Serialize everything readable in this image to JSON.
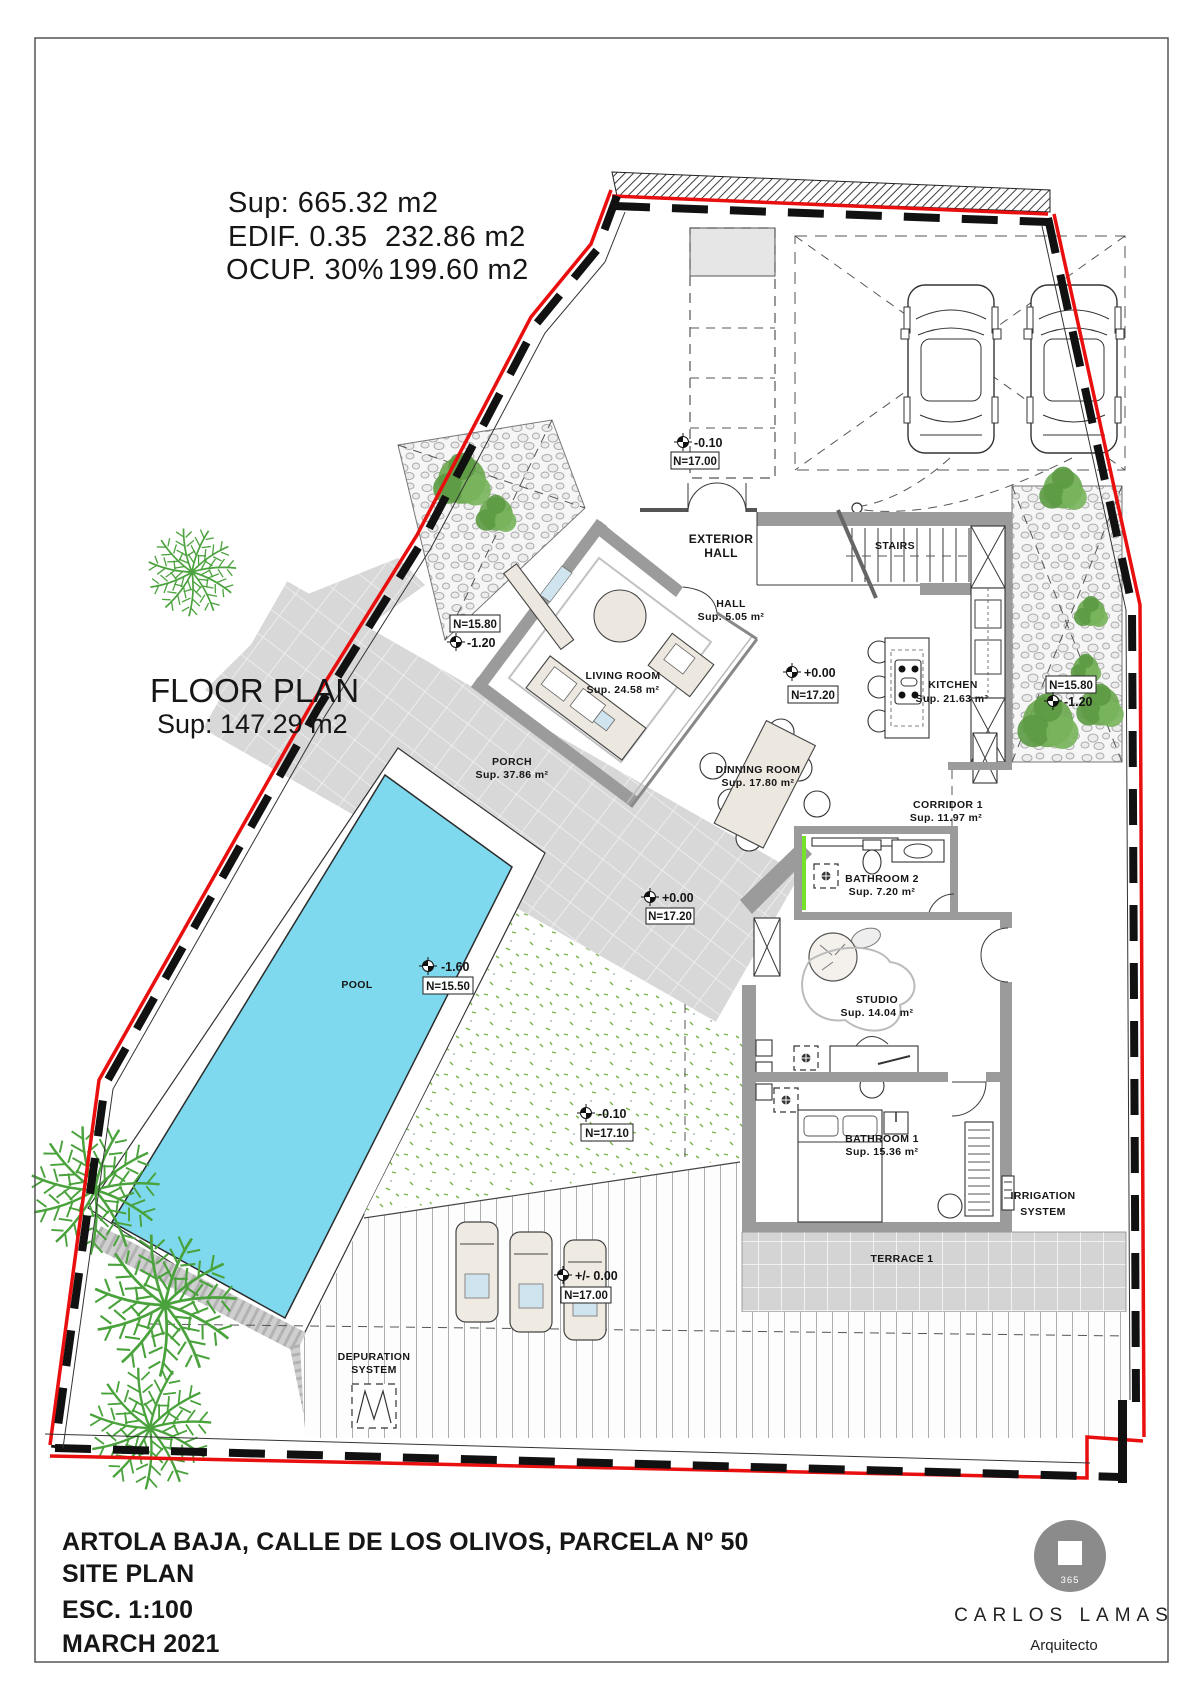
{
  "header_stats": {
    "sup": "Sup: 665.32 m2",
    "edif_label": "EDIF. 0.35",
    "edif_value": "232.86 m2",
    "ocup_label": "OCUP. 30%",
    "ocup_value": "199.60 m2"
  },
  "floor_plan_label": {
    "title": "FLOOR PLAN",
    "area": "Sup: 147.29 m2"
  },
  "rooms": {
    "exterior_hall": {
      "line1": "EXTERIOR",
      "line2": "HALL"
    },
    "stairs": {
      "name": "STAIRS"
    },
    "hall": {
      "name": "HALL",
      "area": "Sup. 5.05 m²"
    },
    "living_room": {
      "name": "LIVING ROOM",
      "area": "Sup. 24.58 m²"
    },
    "kitchen": {
      "name": "KITCHEN",
      "area": "Sup. 21.63 m²"
    },
    "dining_room": {
      "name": "DINNING ROOM",
      "area": "Sup. 17.80 m²"
    },
    "corridor_1": {
      "name": "CORRIDOR 1",
      "area": "Sup. 11.97 m²"
    },
    "bathroom_2": {
      "name": "BATHROOM 2",
      "area": "Sup. 7.20 m²"
    },
    "studio": {
      "name": "STUDIO",
      "area": "Sup. 14.04 m²"
    },
    "bathroom_1": {
      "name": "BATHROOM 1",
      "area": "Sup. 15.36 m²"
    },
    "porch": {
      "name": "PORCH",
      "area": "Sup. 37.86 m²"
    },
    "pool": {
      "name": "POOL"
    },
    "terrace_1": {
      "name": "TERRACE 1"
    },
    "depuration_system": {
      "line1": "DEPURATION",
      "line2": "SYSTEM"
    },
    "irrigation_system": {
      "line1": "IRRIGATION",
      "line2": "SYSTEM"
    }
  },
  "level_markers": {
    "parking": {
      "value": "-0.10",
      "level": "N=17.00"
    },
    "hall": {
      "value": "+0.00",
      "level": "N=17.20"
    },
    "porch": {
      "value": "+0.00",
      "level": "N=17.20"
    },
    "pool": {
      "value": "-1.60",
      "level": "N=15.50"
    },
    "garden": {
      "value": "-0.10",
      "level": "N=17.10"
    },
    "deck": {
      "value": "+/- 0.00",
      "level": "N=17.00"
    },
    "left_garden": {
      "level": "N=15.80",
      "value": "-1.20"
    },
    "right_garden": {
      "level": "N=15.80",
      "value": "-1.20"
    }
  },
  "title_block": {
    "address": "ARTOLA BAJA, CALLE DE LOS OLIVOS, PARCELA Nº 50",
    "plan_type": "SITE PLAN",
    "scale": "ESC. 1:100",
    "date": "MARCH 2021"
  },
  "architect": {
    "name": "CARLOS LAMAS",
    "title": "Arquitecto",
    "logo_number": "365"
  },
  "colors": {
    "pool_water": "#7fd9ee",
    "boundary_red": "#e90f0f",
    "boundary_black": "#111111",
    "wall_gray": "#9b9b9b",
    "paving_gray": "#d8d8d8",
    "vegetation_green": "#4aa23c",
    "window_highlight_green": "#76e32b",
    "pillow_blue": "#cfe4ee"
  }
}
